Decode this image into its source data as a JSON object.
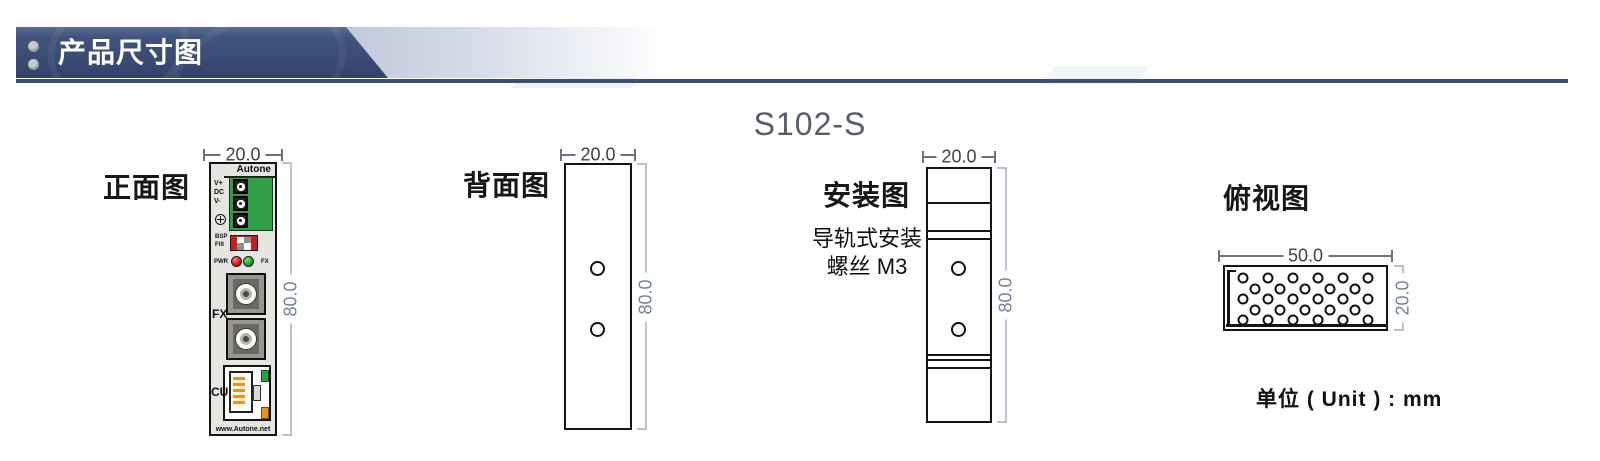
{
  "header": {
    "title": "产品尺寸图"
  },
  "model": "S102-S",
  "unit_note": "单位 ( Unit ) : mm",
  "front": {
    "label": "正面图",
    "dim_top": "20.0",
    "dim_side": "80.0",
    "brand": "Autone",
    "terminals": [
      "V+",
      "DC",
      "V-"
    ],
    "dip": [
      "BSP",
      "Filt"
    ],
    "led_left": "PWR",
    "led_right": "FX",
    "fx_label": "FX",
    "cu_label": "CU",
    "website": "www.Autone.net"
  },
  "back": {
    "label": "背面图",
    "dim_top": "20.0",
    "dim_side": "80.0"
  },
  "install": {
    "label": "安装图",
    "note1": "导轨式安装",
    "note2": "螺丝 M3",
    "dim_top": "20.0",
    "dim_side": "80.0"
  },
  "top": {
    "label": "俯视图",
    "dim_top": "50.0",
    "dim_side": "20.0"
  },
  "colors": {
    "header_navy": "#3a4f78",
    "terminal_green": "#2f9e45",
    "dip_red": "#c4211c",
    "led_red": "#d2150f",
    "led_green": "#1da02e",
    "port_orange": "#e8941f",
    "dimension_blue": "#b6c2d6"
  }
}
